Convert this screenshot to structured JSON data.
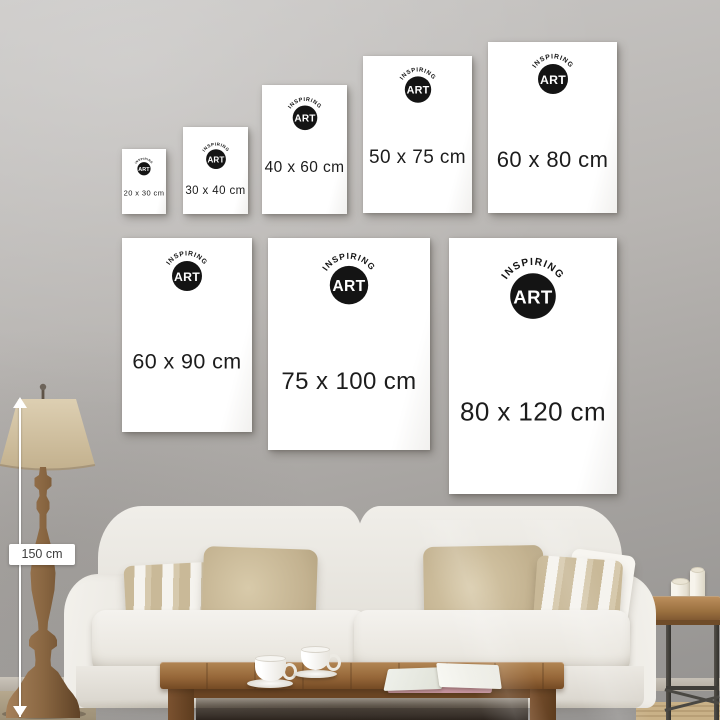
{
  "brand": {
    "arc_text": "INSPIRING",
    "mark": "ART"
  },
  "posters": [
    {
      "id": "20x30",
      "label": "20 x 30 cm",
      "width_cm": 20,
      "height_cm": 30
    },
    {
      "id": "30x40",
      "label": "30 x 40 cm",
      "width_cm": 30,
      "height_cm": 40
    },
    {
      "id": "40x60",
      "label": "40 x 60 cm",
      "width_cm": 40,
      "height_cm": 60
    },
    {
      "id": "50x75",
      "label": "50 x 75 cm",
      "width_cm": 50,
      "height_cm": 75
    },
    {
      "id": "60x80",
      "label": "60 x 80 cm",
      "width_cm": 60,
      "height_cm": 80
    },
    {
      "id": "60x90",
      "label": "60 x 90 cm",
      "width_cm": 60,
      "height_cm": 90
    },
    {
      "id": "75x100",
      "label": "75 x 100 cm",
      "width_cm": 75,
      "height_cm": 100
    },
    {
      "id": "80x120",
      "label": "80 x 120 cm",
      "width_cm": 80,
      "height_cm": 120
    }
  ],
  "measurement": {
    "label": "150 cm",
    "value_cm": 150
  },
  "colors": {
    "wall": "#b7b4b1",
    "poster": "#ffffff",
    "label_text": "#1c1c1c",
    "logo_black": "#141414",
    "sofa": "#edeae4",
    "pillow_beige": "#c8b795",
    "table_wood": "#8f6236",
    "lamp_shade": "#d3c3a3",
    "arrow": "#ffffff"
  }
}
